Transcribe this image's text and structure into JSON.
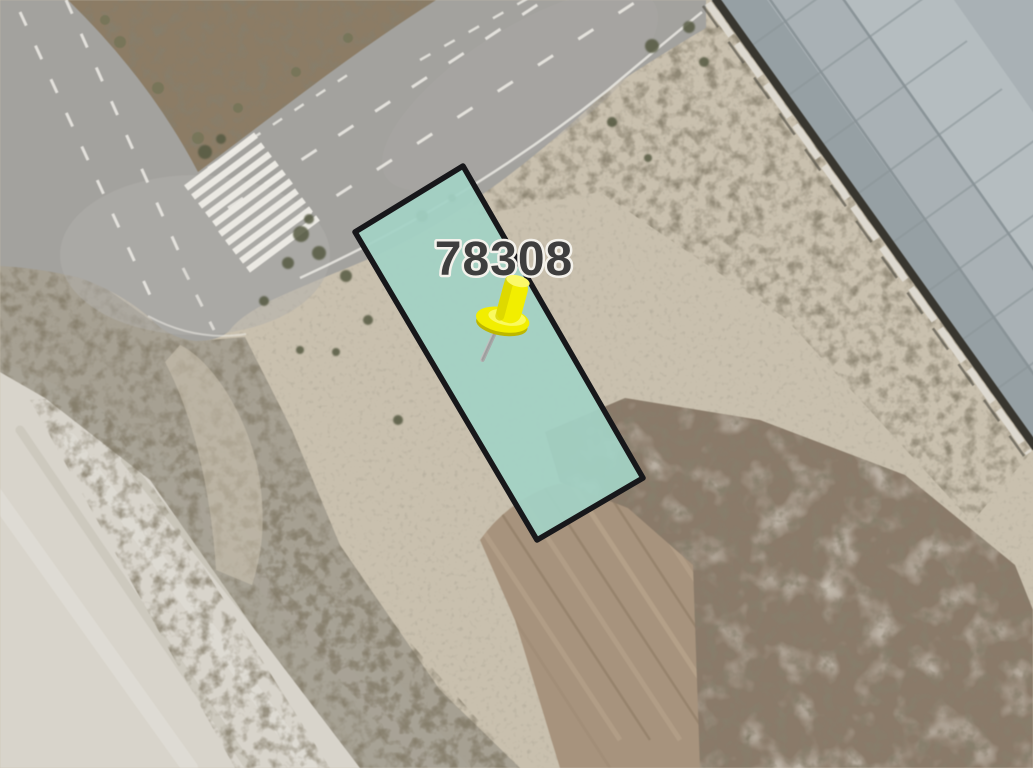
{
  "map": {
    "view": "satellite-imagery",
    "parcel": {
      "label": "78308",
      "fill_color": "#a3d2c5",
      "border_color": "#17171a",
      "label_color": "#3e3e3e",
      "label_outline_color": "#f4f2ec"
    },
    "marker": {
      "name": "yellow-pushpin",
      "body_color": "#f2ee00",
      "shade_color": "#bdb700",
      "highlight_color": "#fbf968",
      "needle_color": "#9a9a9a"
    },
    "features": {
      "road_color": "#a3a29e",
      "road_marking_color": "#efede7",
      "warehouse_roof_color": "#a9b1b5",
      "boundary_wall_color": "#ddd9d0"
    }
  }
}
